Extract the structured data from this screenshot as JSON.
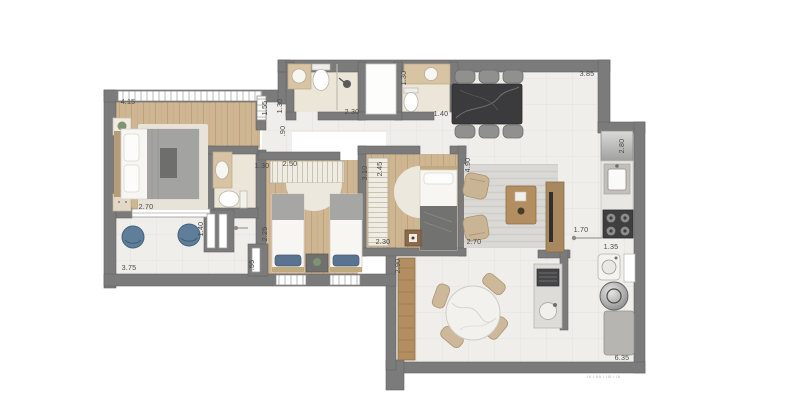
{
  "plan": {
    "kind": "apartment-floor-plan"
  },
  "dims": {
    "master": {
      "window": "4.15",
      "width": "2.70"
    },
    "terrace": {
      "width": "3.75",
      "depth": "1.40",
      "step": ".55"
    },
    "hall": {
      "a": "1.55",
      "b": "1.30",
      "c": ".90"
    },
    "bath1": {
      "width": "2.30"
    },
    "bath2": {
      "length": "1.30",
      "width": "1.40"
    },
    "bedroom2": {
      "left": "1.30",
      "width": "2.50",
      "height": "3.10",
      "depth_left": "2.25"
    },
    "bedroom3": {
      "width": "2.45",
      "lower": "2.30"
    },
    "dining": {
      "width": "3.85"
    },
    "kitchen": {
      "length": "2.80",
      "opening": "1.70"
    },
    "service": {
      "width": "1.35",
      "side": "6.35"
    },
    "living": {
      "height": "4.90",
      "width": "2.70",
      "left": "2.90"
    }
  },
  "fine_print": "lll l llll l llll l lll",
  "colors": {
    "wall": "#7b7b7b",
    "tile_floor": "#efeeeb",
    "wood_floor": "#cfb693",
    "bath_floor": "#ece6d8",
    "rug": "#ebe7dc",
    "blue_chair": "#5e7e9a",
    "dark_table": "#3b3b3d",
    "wood_furniture": "#b28e60"
  }
}
